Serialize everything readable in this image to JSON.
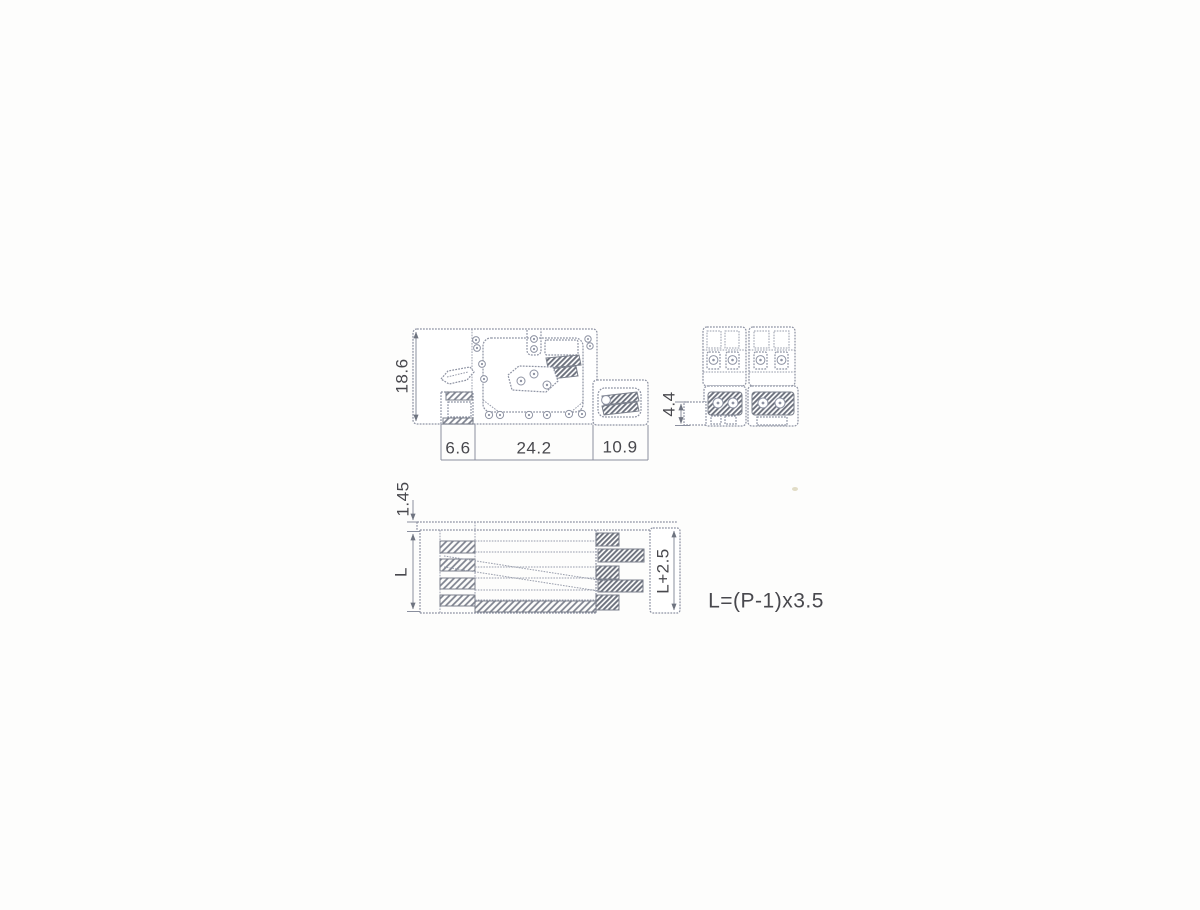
{
  "page": {
    "background": "#fdfdfc"
  },
  "drawing": {
    "kind": "terminal-block-dimension-drawing",
    "line_color": "#8e93a3",
    "hatch_color": "#7b808c",
    "text_color": "#48484d",
    "views": {
      "side_view": {
        "dims": {
          "height": "18.6",
          "width_left": "6.6",
          "width_center": "24.2",
          "width_right": "10.9"
        }
      },
      "front_view": {
        "dims": {
          "pin_height": "4.4"
        }
      },
      "bottom_view": {
        "dims": {
          "flange": "1.45",
          "length": "L",
          "total_length": "L+2.5"
        }
      }
    },
    "formula": "L=(P-1)x3.5"
  }
}
